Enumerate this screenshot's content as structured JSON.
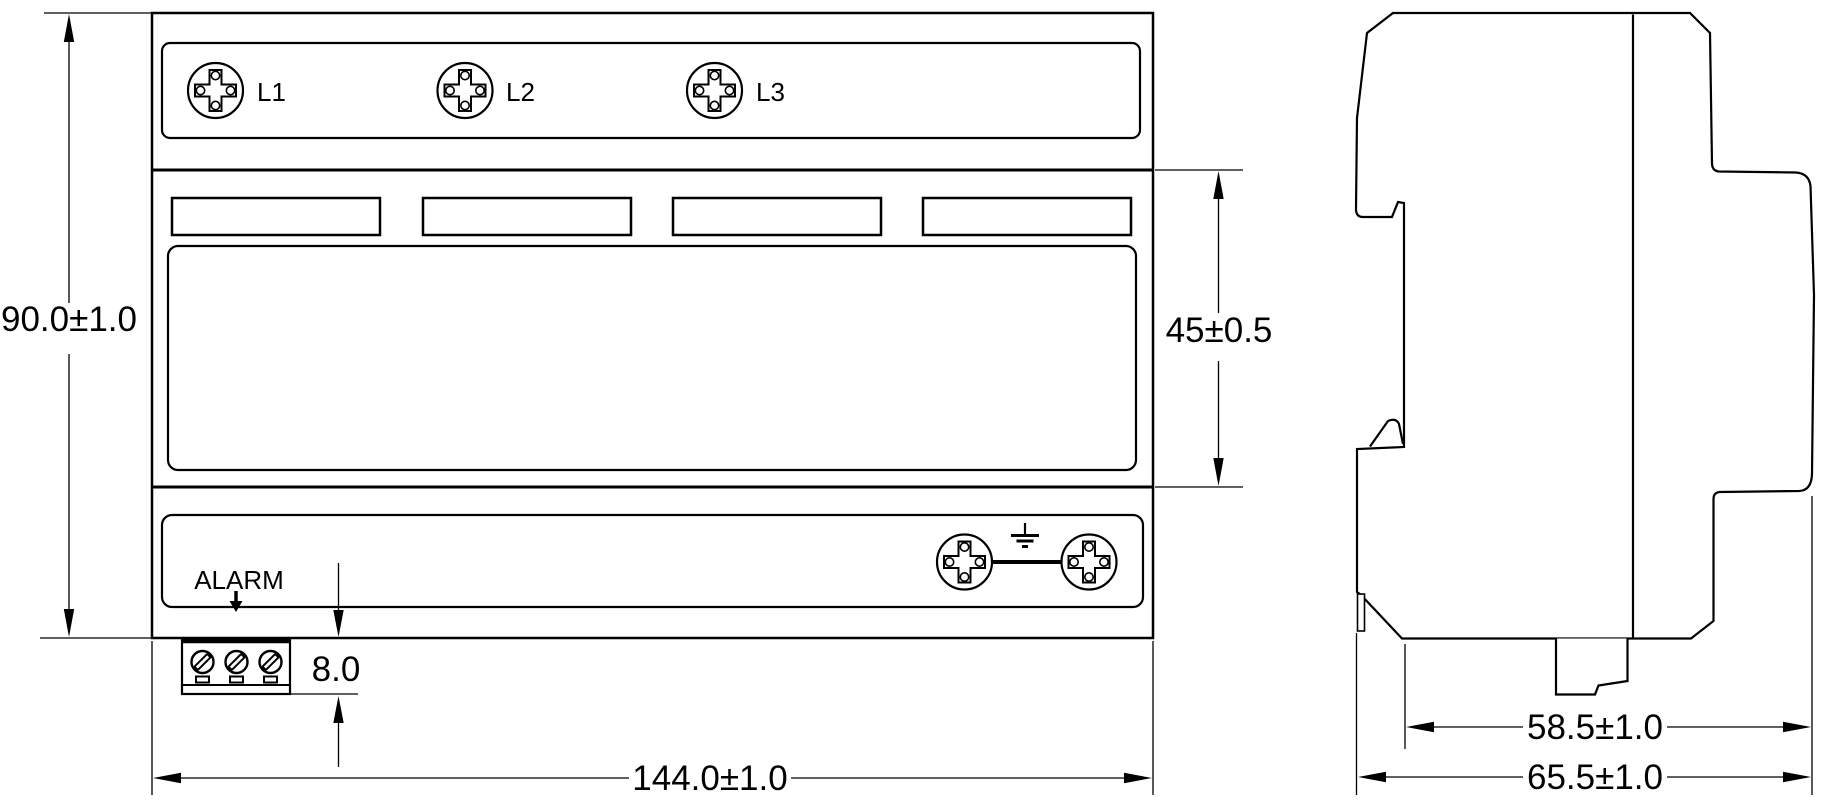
{
  "front_view": {
    "phase_labels": [
      "L1",
      "L2",
      "L3"
    ],
    "alarm_label": "ALARM",
    "dimensions": {
      "overall_height": "90.0±1.0",
      "middle_section_height": "45±0.5",
      "terminal_block_height": "8.0",
      "overall_width": "144.0±1.0"
    }
  },
  "side_view": {
    "dimensions": {
      "depth_without_clip": "58.5±1.0",
      "overall_depth": "65.5±1.0"
    }
  },
  "colors": {
    "line": "#000000",
    "background": "#ffffff"
  }
}
